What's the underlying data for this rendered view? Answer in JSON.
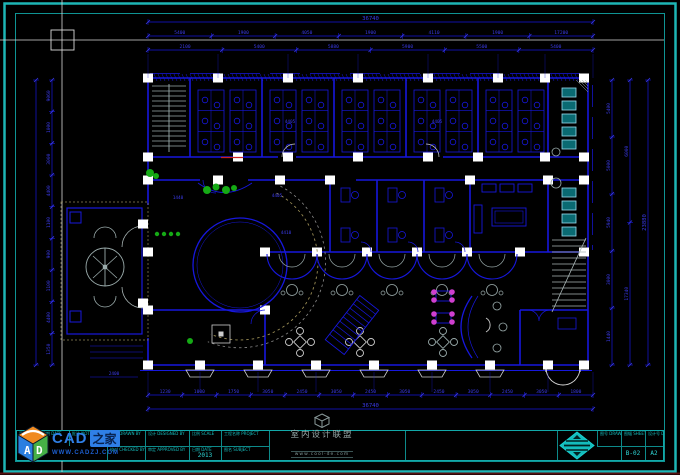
{
  "dimensions": {
    "top_total": "36740",
    "top_row": [
      "5400",
      "1900",
      "4050",
      "1900",
      "4110",
      "1900",
      "17200"
    ],
    "top_row2": [
      "2100",
      "5400",
      "5880",
      "5900",
      "5500",
      "5400"
    ],
    "bottom_row": [
      "1230",
      "1000",
      "1750",
      "3050",
      "2450",
      "3050",
      "2450",
      "3050",
      "2450",
      "3050",
      "2450",
      "3050",
      "1800"
    ],
    "bottom_total": "36740",
    "left_col": [
      "9060",
      "1000",
      "3000",
      "4400",
      "1100",
      "900",
      "1100",
      "4400",
      "1350"
    ],
    "right_col": [
      "5400",
      "5000",
      "5940",
      "3000",
      "1440"
    ],
    "right_col2": [
      "6000",
      "17340"
    ],
    "right_total": "23880"
  },
  "interior_labels": [
    "1440",
    "4405",
    "4410",
    "4405",
    "4405",
    "2400"
  ],
  "titlebar": {
    "rev": "更改",
    "date1": "日期 DATE",
    "notes": "批注 NOTES",
    "drawn": "描图 DRAWN BY",
    "designed": "设计 DESIGNED BY",
    "scale": "比例 SCALE",
    "project": "工程名称 PROJECT",
    "checked": "校对 CHECKED BY",
    "approved": "审定 APPROVED BY",
    "date2": "日期 DATE",
    "date_value": "2013",
    "subject": "图名 SUBJECT",
    "drawing_no": "图号 DRAWING NO",
    "sheet_no": "图幅 SHEET NO",
    "design_no": "设计号 DESIGN NO",
    "sheet_value": "B-02",
    "design_value": "A2"
  },
  "logos": {
    "cadzj_cad": "CAD",
    "cadzj_home": "之家",
    "cadzj_url": "WWW.CADZJ.COM",
    "cadzj_letter_a": "A",
    "cadzj_letter_d": "D",
    "watermark_name": "室内设计联盟",
    "watermark_url": "www.cool-de.com"
  }
}
